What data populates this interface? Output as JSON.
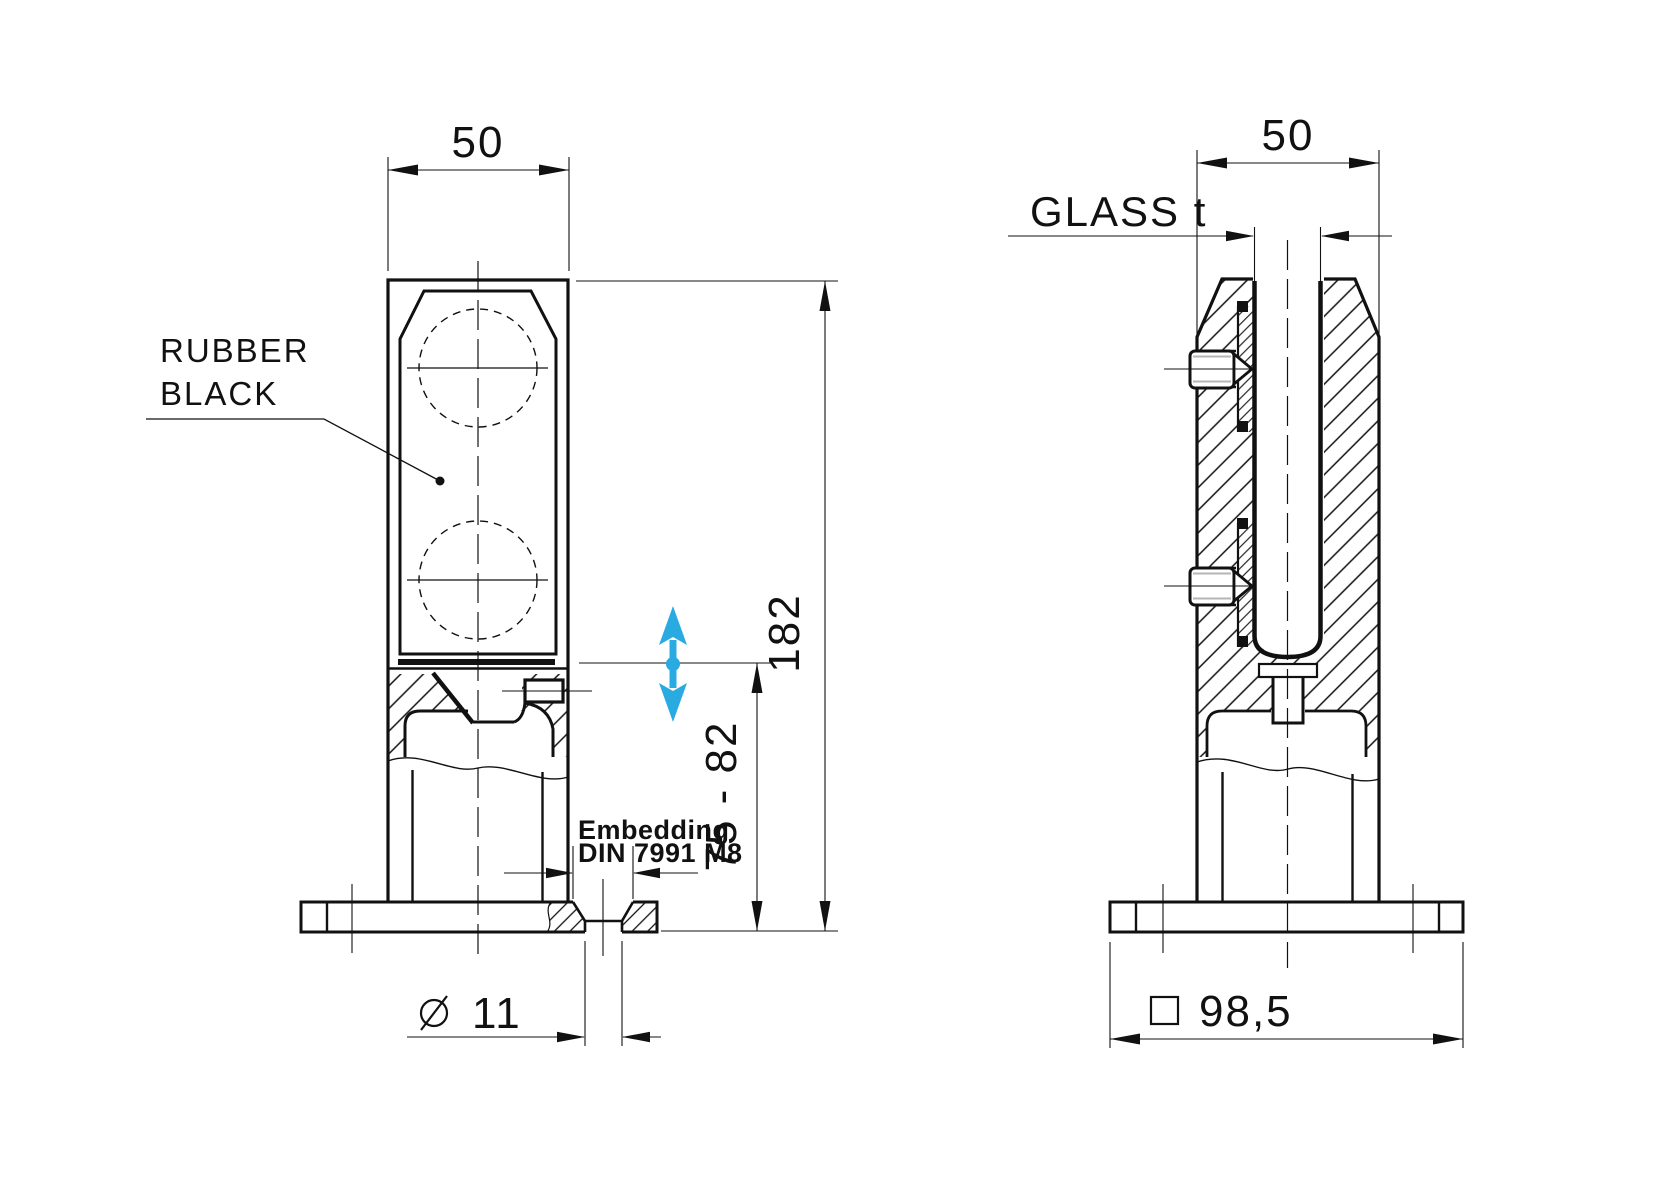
{
  "colors": {
    "line": "#111111",
    "accent": "#29ABE2"
  },
  "front_view": {
    "width": "50",
    "material_note_line1": "RUBBER",
    "material_note_line2": "BLACK",
    "overall_height": "182",
    "adjust_range": "75 - 82",
    "embedding_note_line1": "Embedding",
    "embedding_note_line2": "DIN 7991 M8",
    "hole_diameter": "11"
  },
  "side_view": {
    "width": "50",
    "glass_thickness": "GLASS t",
    "base_width": "98,5"
  }
}
